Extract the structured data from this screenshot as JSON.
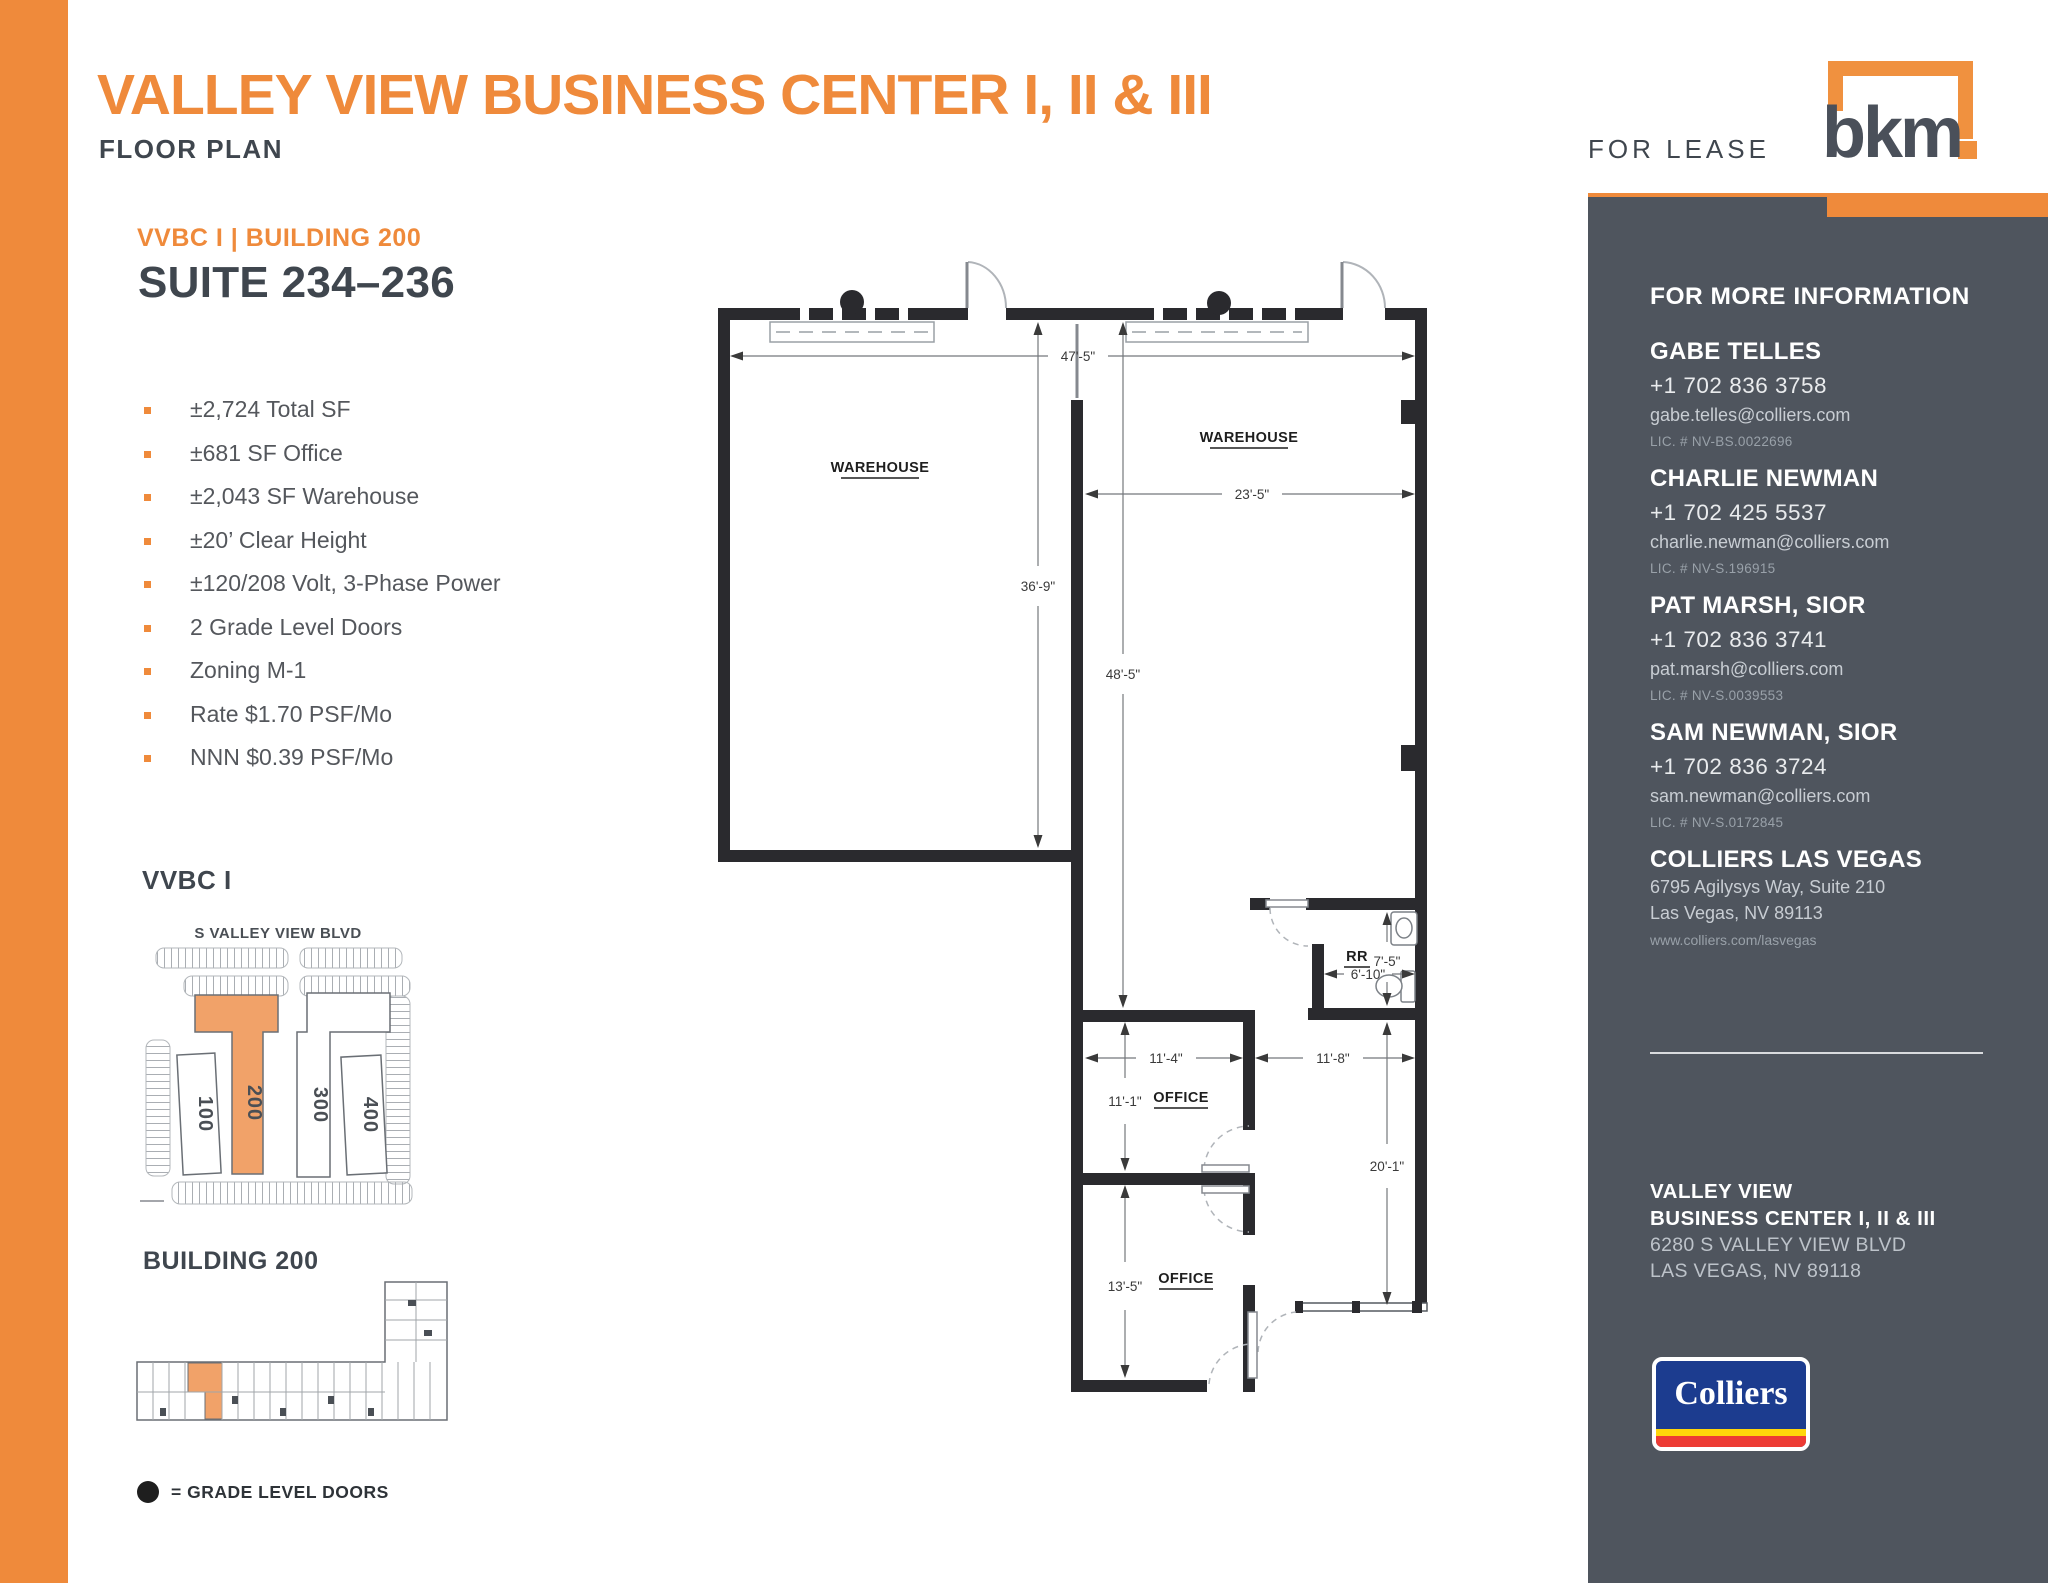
{
  "header": {
    "title": "VALLEY VIEW BUSINESS CENTER I, II & III",
    "subtitle": "FLOOR PLAN",
    "for_lease": "FOR LEASE",
    "bkm_logo_text": "bkm"
  },
  "listing": {
    "building_label": "VVBC I  |  BUILDING 200",
    "suite": "SUITE 234–236",
    "features": [
      "±2,724 Total SF",
      "±681 SF Office",
      "±2,043 SF Warehouse",
      "±20’ Clear Height",
      "±120/208 Volt, 3-Phase Power",
      "2 Grade Level Doors",
      "Zoning M-1",
      "Rate $1.70 PSF/Mo",
      "NNN $0.39 PSF/Mo"
    ]
  },
  "floor_plan": {
    "rooms": {
      "warehouse_left": "WAREHOUSE",
      "warehouse_right": "WAREHOUSE",
      "office_top": "OFFICE",
      "office_bottom": "OFFICE",
      "restroom": "RR"
    },
    "dims": {
      "top_width": "47'-5\"",
      "left_depth": "36'-9\"",
      "right_width": "23'-5\"",
      "right_depth": "48'-5\"",
      "rr_depth": "7'-5\"",
      "rr_width": "6'-10\"",
      "office_top_width": "11'-4\"",
      "corridor_width": "11'-8\"",
      "office_top_depth": "11'-1\"",
      "corridor_depth": "20'-1\"",
      "office_bottom_depth": "13'-5\""
    }
  },
  "site_plan": {
    "heading": "VVBC I",
    "street": "S VALLEY VIEW BLVD",
    "buildings": [
      "100",
      "200",
      "300",
      "400"
    ]
  },
  "building_plan": {
    "heading": "BUILDING 200"
  },
  "legend": {
    "text": "= GRADE LEVEL DOORS"
  },
  "sidebar": {
    "heading": "FOR MORE INFORMATION",
    "contacts": [
      {
        "name": "GABE TELLES",
        "phone": "+1 702 836 3758",
        "email": "gabe.telles@colliers.com",
        "lic": "LIC. # NV-BS.0022696"
      },
      {
        "name": "CHARLIE NEWMAN",
        "phone": "+1 702 425 5537",
        "email": "charlie.newman@colliers.com",
        "lic": "LIC. # NV-S.196915"
      },
      {
        "name": "PAT MARSH, SIOR",
        "phone": "+1 702 836 3741",
        "email": "pat.marsh@colliers.com",
        "lic": "LIC. # NV-S.0039553"
      },
      {
        "name": "SAM NEWMAN, SIOR",
        "phone": "+1 702 836 3724",
        "email": "sam.newman@colliers.com",
        "lic": "LIC. # NV-S.0172845"
      }
    ],
    "office": {
      "name": "COLLIERS LAS VEGAS",
      "address1": "6795 Agilysys Way, Suite 210",
      "address2": "Las Vegas, NV 89113",
      "web": "www.colliers.com/lasvegas"
    },
    "property": {
      "line1": "VALLEY VIEW",
      "line2": "BUSINESS CENTER  I, II & III",
      "line3": "6280 S VALLEY VIEW BLVD",
      "line4": "LAS VEGAS, NV 89118"
    },
    "colliers_logo_text": "Colliers"
  },
  "colors": {
    "accent_orange": "#EF8A3B",
    "site_highlight_orange": "#F1A269",
    "dark_heading": "#3F464E",
    "body_gray": "#54575C",
    "sidebar_bg": "#4F555E",
    "colliers_blue": "#1C3C8F",
    "colliers_yellow": "#FFD60A",
    "colliers_red": "#ED3B34"
  }
}
